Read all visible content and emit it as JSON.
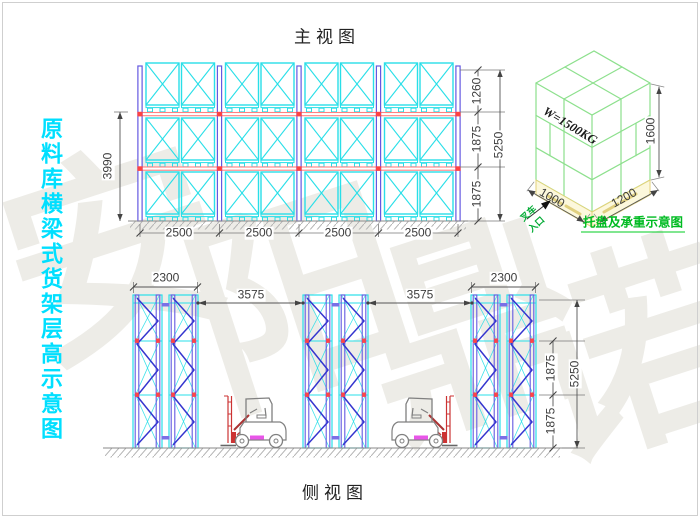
{
  "watermark": {
    "chars": [
      "安",
      "阳",
      "鼎",
      "诺"
    ]
  },
  "left_caption": {
    "text": "原料库横梁式货架层高示意图"
  },
  "front_view": {
    "title": "主视图",
    "dim_bay1": "2500",
    "dim_bay2": "2500",
    "dim_bay3": "2500",
    "dim_bay4": "2500",
    "dim_height_beam": "3990",
    "dim_top": "1260",
    "dim_mid": "1875",
    "dim_bot": "1875",
    "dim_total": "5250"
  },
  "side_view": {
    "title": "侧视图",
    "dim_depth_left": "2300",
    "dim_depth_right": "2300",
    "dim_aisle1": "3575",
    "dim_aisle2": "3575",
    "dim_mid": "1875",
    "dim_bot": "1875",
    "dim_total": "5250"
  },
  "pallet_diagram": {
    "load": "W=1500KG",
    "dim_height": "1600",
    "dim_width": "1000",
    "dim_depth": "1200",
    "entry_line1": "叉车",
    "entry_line2": "入口",
    "caption": "托盘及承重示意图"
  },
  "colors": {
    "rack_cyan": "#29dfe8",
    "upright_purple": "#6459e0",
    "beam_red": "#ff8080",
    "brace_blue": "#3535cf",
    "green_text": "#00bb22",
    "left_caption_cyan": "#00dfff"
  }
}
